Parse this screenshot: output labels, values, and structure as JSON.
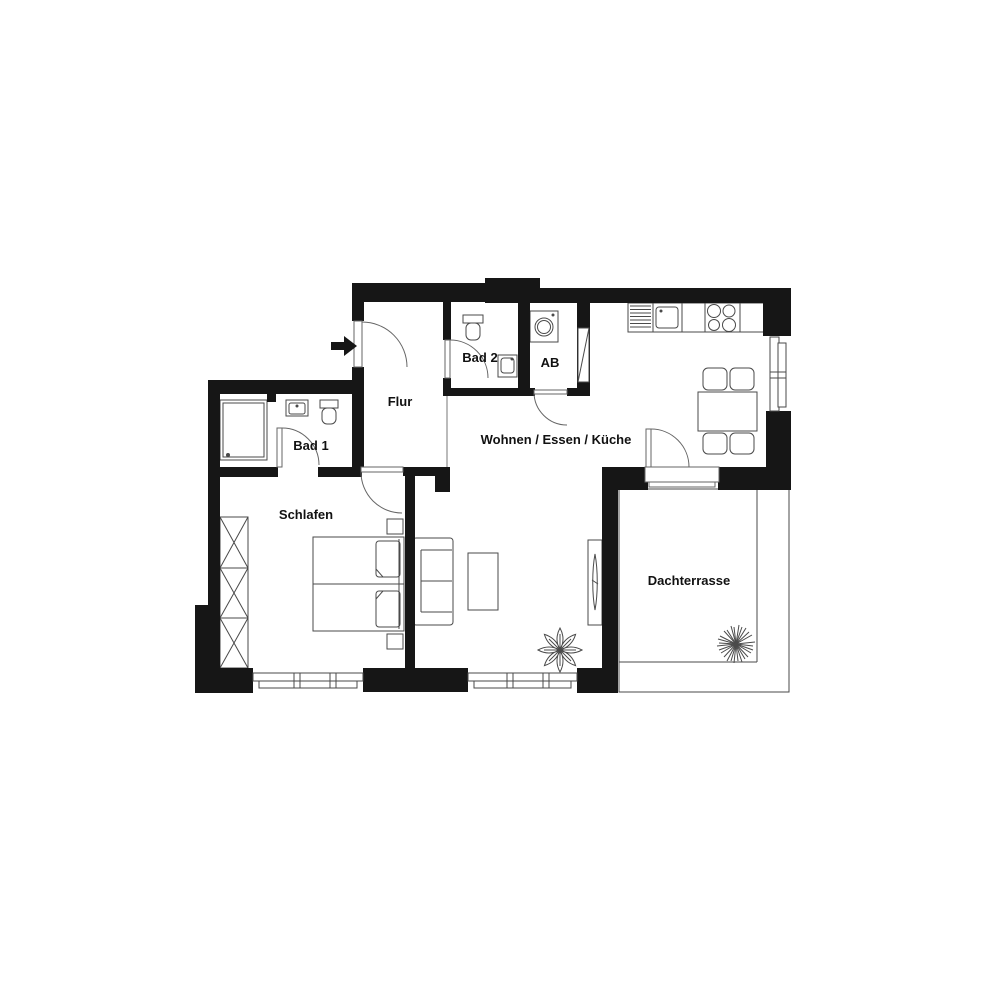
{
  "plan": {
    "type": "floor-plan",
    "rooms": {
      "flur": {
        "label": "Flur"
      },
      "bad1": {
        "label": "Bad 1"
      },
      "bad2": {
        "label": "Bad 2"
      },
      "ab": {
        "label": "AB"
      },
      "wohnen": {
        "label": "Wohnen / Essen / Küche"
      },
      "schlafen": {
        "label": "Schlafen"
      },
      "dachterrasse": {
        "label": "Dachterrasse"
      }
    },
    "colors": {
      "wall": "#161616",
      "furniture_line": "#4a4a4a",
      "label": "#111111",
      "background": "#ffffff"
    }
  }
}
